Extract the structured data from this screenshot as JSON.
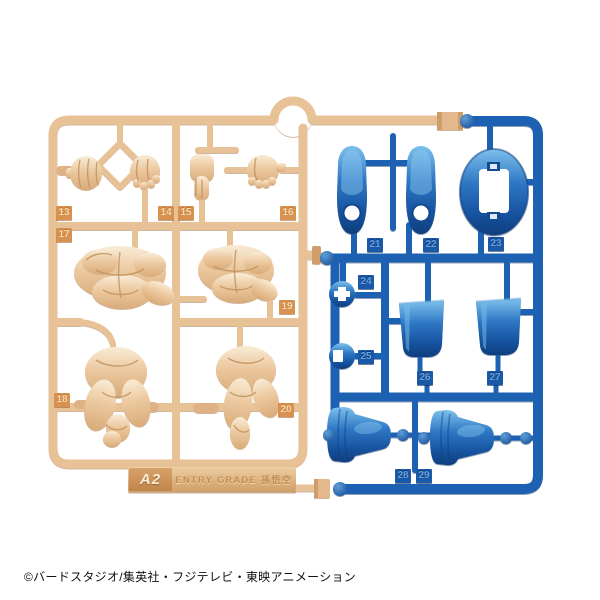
{
  "photo": {
    "description": "Plastic model kit runner sprues on white background",
    "copyright": "©バードスタジオ/集英社・フジテレビ・東映アニメーション",
    "background_color": "#ffffff"
  },
  "tan_runner": {
    "code": "A2",
    "title": "ENTRY GRADE 孫悟空",
    "plastic_color": "#e7c296",
    "tag_color": "#d8914f",
    "contents": "hands and torso parts in flesh-color plastic",
    "tags": [
      "13",
      "14",
      "15",
      "16",
      "17",
      "18",
      "19",
      "20"
    ]
  },
  "blue_runner": {
    "plastic_color": "#1d62b2",
    "contents": "boots, belt buckle and clothing parts in blue plastic",
    "tags": [
      "21",
      "22",
      "23",
      "24",
      "25",
      "26",
      "27",
      "28",
      "29"
    ]
  }
}
